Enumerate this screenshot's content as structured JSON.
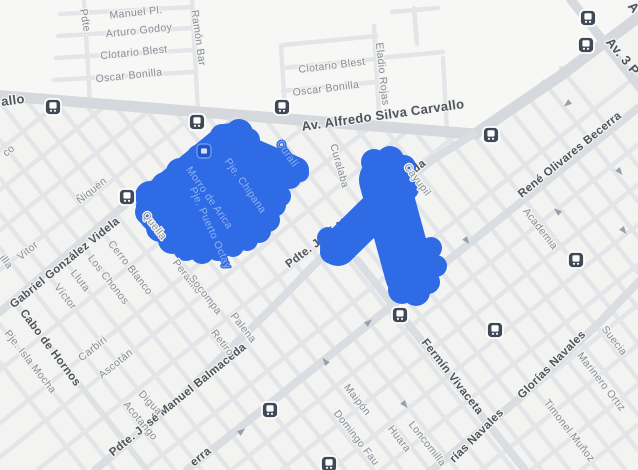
{
  "map": {
    "street_labels": [
      {
        "id": "av-silva",
        "text": "Av. Alfredo Silva Carvallo"
      },
      {
        "id": "carvallo-frag",
        "text": "allo"
      },
      {
        "id": "av-3p",
        "text": "Av. 3 P"
      },
      {
        "id": "a-frag",
        "text": "A"
      },
      {
        "id": "gonzalez-videla",
        "text": "Gabriel González Videla"
      },
      {
        "id": "cabo-hornos",
        "text": "Cabo de Hornos"
      },
      {
        "id": "balmaceda-bottom",
        "text": "Pdte. José Manuel Balmaceda"
      },
      {
        "id": "balmaceda-center",
        "text": "Pdte. José Manuel Balmaceda"
      },
      {
        "id": "rene-olivares",
        "text": "René Olivares Becerra"
      },
      {
        "id": "fermin-vivaceta",
        "text": "Fermín Vivaceta"
      },
      {
        "id": "glorias-navales-1",
        "text": "Glorías Navales"
      },
      {
        "id": "glorias-navales-2",
        "text": "rías Navales"
      },
      {
        "id": "becerra-frag",
        "text": "erra"
      },
      {
        "id": "manuel-pl",
        "text": "Manuel Pl."
      },
      {
        "id": "arturo-godoy",
        "text": "Arturo Godoy"
      },
      {
        "id": "clotario-blest-1",
        "text": "Clotario Blest"
      },
      {
        "id": "oscar-bonilla-1",
        "text": "Oscar Bonilla"
      },
      {
        "id": "pdte-frag",
        "text": "Pdte."
      },
      {
        "id": "ramon-bar",
        "text": "Ramón Bar"
      },
      {
        "id": "clotario-blest-2",
        "text": "Clotario Blest"
      },
      {
        "id": "oscar-bonilla-2",
        "text": "Oscar Bonilla"
      },
      {
        "id": "eladio-rojas",
        "text": "Eladio Rojas"
      },
      {
        "id": "co-frag",
        "text": "co"
      },
      {
        "id": "niquen",
        "text": "Ñiquén"
      },
      {
        "id": "vitor",
        "text": "Vitor"
      },
      {
        "id": "illa-frag",
        "text": "illa"
      },
      {
        "id": "victor",
        "text": "Víctor"
      },
      {
        "id": "lluta",
        "text": "Lluta"
      },
      {
        "id": "los-chonos",
        "text": "Los Chonos"
      },
      {
        "id": "cerro-blanco",
        "text": "Cerro Blanco"
      },
      {
        "id": "pje-isla-mocha",
        "text": "Pje. Isla Mocha"
      },
      {
        "id": "carbiri",
        "text": "Carbiri"
      },
      {
        "id": "ascotan",
        "text": "Ascotán"
      },
      {
        "id": "quella",
        "text": "Quella"
      },
      {
        "id": "peralillo",
        "text": "Peralillo"
      },
      {
        "id": "socompa",
        "text": "Socompa"
      },
      {
        "id": "retiro",
        "text": "Retiro"
      },
      {
        "id": "palena",
        "text": "Palena"
      },
      {
        "id": "digua",
        "text": "Digua"
      },
      {
        "id": "acotango",
        "text": "Acotango"
      },
      {
        "id": "curalaba",
        "text": "Curalaba"
      },
      {
        "id": "cayupil",
        "text": "Cayupil"
      },
      {
        "id": "academia",
        "text": "Academia"
      },
      {
        "id": "suecia",
        "text": "Suecia"
      },
      {
        "id": "marinero-ortiz",
        "text": "Marinero Ortiz"
      },
      {
        "id": "timonel-munoz",
        "text": "Timonel Muñoz"
      },
      {
        "id": "maipon",
        "text": "Maipón"
      },
      {
        "id": "domingo-fau",
        "text": "Domingo Fau"
      },
      {
        "id": "huara",
        "text": "Huara"
      },
      {
        "id": "loncomilla",
        "text": "Loncomilla"
      },
      {
        "id": "morro-arica",
        "text": "Morro de Arica"
      },
      {
        "id": "pje-chipana",
        "text": "Pje. Chipana"
      },
      {
        "id": "curali",
        "text": "Curalí"
      },
      {
        "id": "pto-octay",
        "text": "Pje. Puerto Octay"
      }
    ],
    "icons": {
      "bus_stop": "bus-stop-icon",
      "bus_stop_count": 12,
      "place": "place-icon"
    },
    "highlighted_area": {
      "name": "selected-blocks-highlight",
      "color": "#2e6be4"
    }
  },
  "colors": {
    "background": "#f3f4f1",
    "road_minor": "#e3e5e8",
    "road_major": "#dadde1",
    "avenue": "#d5d8dc",
    "label_minor": "#878d97",
    "label_major": "#4d545c",
    "label_on_highlight": "#8fb1f2",
    "highlight": "#2e6be4",
    "bus_icon": "#3f4a58"
  }
}
